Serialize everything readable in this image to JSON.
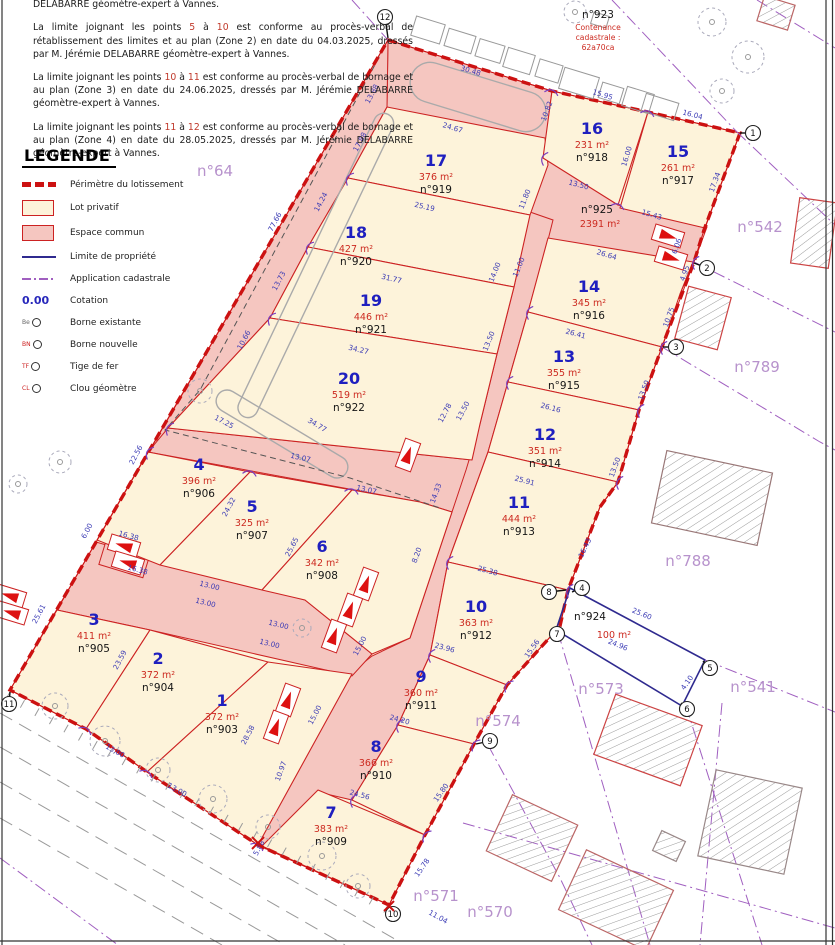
{
  "notes": {
    "paragraphs": [
      {
        "segments": [
          {
            "t": "bornage et au plan (Zone 1) en date du 14.10.2025, dressés par M. Jérémie DELABARRE géomètre-expert à Vannes."
          }
        ]
      },
      {
        "segments": [
          {
            "t": "La limite joignant les points "
          },
          {
            "t": "5",
            "hl": true
          },
          {
            "t": " à "
          },
          {
            "t": "10",
            "hl": true
          },
          {
            "t": " est conforme au procès-verbal de rétablissement des limites et au plan (Zone 2) en date du 04.03.2025, dressés par M. Jérémie DELABARRE géomètre-expert à Vannes."
          }
        ]
      },
      {
        "segments": [
          {
            "t": "La limite joignant les points "
          },
          {
            "t": "10",
            "hl": true
          },
          {
            "t": " à "
          },
          {
            "t": "11",
            "hl": true
          },
          {
            "t": " est conforme au procès-verbal de bornage et au plan (Zone 3) en date du 24.06.2025, dressés par M. Jérémie DELABARRE géomètre-expert à Vannes."
          }
        ]
      },
      {
        "segments": [
          {
            "t": "La limite joignant les points "
          },
          {
            "t": "11",
            "hl": true
          },
          {
            "t": " à "
          },
          {
            "t": "12",
            "hl": true
          },
          {
            "t": " est conforme au procès-verbal de bornage et au plan (Zone 4) en date du 28.05.2025, dressés par M. Jérémie DELABARRE géomètre-expert à Vannes."
          }
        ]
      }
    ]
  },
  "legend": {
    "title": "LEGENDE",
    "items": [
      {
        "kind": "perimetre",
        "label": "Périmètre du lotissement"
      },
      {
        "kind": "lot",
        "label": "Lot privatif"
      },
      {
        "kind": "commun",
        "label": "Espace commun"
      },
      {
        "kind": "limite",
        "label": "Limite de propriété"
      },
      {
        "kind": "cadastrale",
        "label": "Application cadastrale"
      },
      {
        "kind": "cotation",
        "label": "Cotation",
        "symbol": "0.00"
      },
      {
        "kind": "borne",
        "label": "Borne existante",
        "prefix": "Be",
        "color": "#666666"
      },
      {
        "kind": "borne",
        "label": "Borne nouvelle",
        "prefix": "BN",
        "color": "#cc2222"
      },
      {
        "kind": "borne",
        "label": "Tige de fer",
        "prefix": "TF",
        "color": "#cc2222"
      },
      {
        "kind": "borne",
        "label": "Clou géomètre",
        "prefix": "CL",
        "color": "#cc2222"
      }
    ]
  },
  "lots": [
    {
      "n": "1",
      "area": "372 m²",
      "parcel": "n°903",
      "x": 222,
      "y": 706
    },
    {
      "n": "2",
      "area": "372 m²",
      "parcel": "n°904",
      "x": 158,
      "y": 664
    },
    {
      "n": "3",
      "area": "411 m²",
      "parcel": "n°905",
      "x": 94,
      "y": 625
    },
    {
      "n": "4",
      "area": "396 m²",
      "parcel": "n°906",
      "x": 199,
      "y": 470
    },
    {
      "n": "5",
      "area": "325 m²",
      "parcel": "n°907",
      "x": 252,
      "y": 512
    },
    {
      "n": "6",
      "area": "342 m²",
      "parcel": "n°908",
      "x": 322,
      "y": 552
    },
    {
      "n": "7",
      "area": "383 m²",
      "parcel": "n°909",
      "x": 331,
      "y": 818
    },
    {
      "n": "8",
      "area": "366 m²",
      "parcel": "n°910",
      "x": 376,
      "y": 752
    },
    {
      "n": "9",
      "area": "360 m²",
      "parcel": "n°911",
      "x": 421,
      "y": 682
    },
    {
      "n": "10",
      "area": "363 m²",
      "parcel": "n°912",
      "x": 476,
      "y": 612
    },
    {
      "n": "11",
      "area": "444 m²",
      "parcel": "n°913",
      "x": 519,
      "y": 508
    },
    {
      "n": "12",
      "area": "351 m²",
      "parcel": "n°914",
      "x": 545,
      "y": 440
    },
    {
      "n": "13",
      "area": "355 m²",
      "parcel": "n°915",
      "x": 564,
      "y": 362
    },
    {
      "n": "14",
      "area": "345 m²",
      "parcel": "n°916",
      "x": 589,
      "y": 292
    },
    {
      "n": "15",
      "area": "261 m²",
      "parcel": "n°917",
      "x": 678,
      "y": 157
    },
    {
      "n": "16",
      "area": "231 m²",
      "parcel": "n°918",
      "x": 592,
      "y": 134
    },
    {
      "n": "17",
      "area": "376 m²",
      "parcel": "n°919",
      "x": 436,
      "y": 166
    },
    {
      "n": "18",
      "area": "427 m²",
      "parcel": "n°920",
      "x": 356,
      "y": 238
    },
    {
      "n": "19",
      "area": "446 m²",
      "parcel": "n°921",
      "x": 371,
      "y": 306
    },
    {
      "n": "20",
      "area": "519 m²",
      "parcel": "n°922",
      "x": 349,
      "y": 384
    }
  ],
  "common_areas": {
    "n923": {
      "name": "n°923",
      "lines": [
        "Contenance",
        "cadastrale :",
        "62a70ca"
      ],
      "x": 598,
      "y": 18
    },
    "n925": {
      "name": "n°925",
      "area": "2391 m²",
      "x": 597,
      "y": 213
    },
    "n924": {
      "name": "n°924",
      "area": "100 m²",
      "x": 590,
      "y": 620,
      "ax": 614,
      "ay": 638
    }
  },
  "neighbor_parcels": [
    {
      "label": "n°64",
      "x": 215,
      "y": 176
    },
    {
      "label": "n°542",
      "x": 760,
      "y": 232
    },
    {
      "label": "n°789",
      "x": 757,
      "y": 372
    },
    {
      "label": "n°788",
      "x": 688,
      "y": 566
    },
    {
      "label": "n°541",
      "x": 753,
      "y": 692
    },
    {
      "label": "n°573",
      "x": 601,
      "y": 694
    },
    {
      "label": "n°574",
      "x": 498,
      "y": 726
    },
    {
      "label": "n°571",
      "x": 436,
      "y": 901
    },
    {
      "label": "n°570",
      "x": 490,
      "y": 917
    }
  ],
  "boundary_points": [
    {
      "n": "1",
      "cx": 753,
      "cy": 133,
      "tx": 740,
      "ty": 133
    },
    {
      "n": "2",
      "cx": 707,
      "cy": 268,
      "tx": 694,
      "ty": 263
    },
    {
      "n": "3",
      "cx": 676,
      "cy": 347,
      "tx": 663,
      "ty": 347
    },
    {
      "n": "4",
      "cx": 582,
      "cy": 588,
      "tx": 572,
      "ty": 592
    },
    {
      "n": "5",
      "cx": 710,
      "cy": 668,
      "tx": 703,
      "ty": 661
    },
    {
      "n": "6",
      "cx": 687,
      "cy": 709,
      "tx": 681,
      "ty": 703
    },
    {
      "n": "7",
      "cx": 557,
      "cy": 634,
      "tx": 558,
      "ty": 628
    },
    {
      "n": "8",
      "cx": 549,
      "cy": 592,
      "tx": 566,
      "ty": 590
    },
    {
      "n": "9",
      "cx": 490,
      "cy": 741,
      "tx": 476,
      "ty": 744
    },
    {
      "n": "10",
      "cx": 393,
      "cy": 914,
      "tx": 389,
      "ty": 906
    },
    {
      "n": "11",
      "cx": 9,
      "cy": 704,
      "tx": 10,
      "ty": 692
    },
    {
      "n": "12",
      "cx": 385,
      "cy": 17,
      "tx": 388,
      "ty": 38
    }
  ],
  "dimensions": [
    [
      "30.48",
      470,
      73,
      17
    ],
    [
      "24.67",
      452,
      130,
      17
    ],
    [
      "15.95",
      602,
      97,
      17
    ],
    [
      "16.04",
      692,
      117,
      15
    ],
    [
      "17.34",
      717,
      183,
      -70
    ],
    [
      "10.82",
      549,
      112,
      -70
    ],
    [
      "16.00",
      629,
      157,
      -73
    ],
    [
      "13.50",
      578,
      187,
      15
    ],
    [
      "15.43",
      651,
      217,
      17
    ],
    [
      "26.64",
      606,
      257,
      17
    ],
    [
      "6.06",
      679,
      247,
      -70
    ],
    [
      "4.95",
      687,
      274,
      -70
    ],
    [
      "10.75",
      671,
      318,
      -70
    ],
    [
      "26.41",
      575,
      336,
      15
    ],
    [
      "13.50",
      646,
      391,
      -70
    ],
    [
      "26.16",
      550,
      410,
      15
    ],
    [
      "13.50",
      617,
      468,
      -70
    ],
    [
      "25.91",
      524,
      483,
      15
    ],
    [
      "16.43",
      587,
      549,
      -64
    ],
    [
      "25.38",
      487,
      573,
      15
    ],
    [
      "15.56",
      534,
      650,
      -55
    ],
    [
      "23.96",
      444,
      650,
      15
    ],
    [
      "24.20",
      399,
      722,
      15
    ],
    [
      "15.80",
      443,
      794,
      -55
    ],
    [
      "24.56",
      359,
      797,
      15
    ],
    [
      "15.78",
      424,
      869,
      -55
    ],
    [
      "25.19",
      424,
      209,
      13
    ],
    [
      "31.77",
      391,
      281,
      13
    ],
    [
      "34.27",
      358,
      352,
      13
    ],
    [
      "34.77",
      316,
      427,
      31
    ],
    [
      "17.25",
      223,
      424,
      28
    ],
    [
      "13.07",
      300,
      460,
      13
    ],
    [
      "13.07",
      366,
      492,
      13
    ],
    [
      "24.32",
      231,
      508,
      -62
    ],
    [
      "25.65",
      294,
      548,
      -62
    ],
    [
      "17.88",
      362,
      143,
      -62
    ],
    [
      "14.24",
      323,
      203,
      -62
    ],
    [
      "13.73",
      281,
      282,
      -62
    ],
    [
      "10.66",
      246,
      341,
      -62
    ],
    [
      "77.66",
      277,
      223,
      -62
    ],
    [
      "13.88",
      374,
      95,
      -62
    ],
    [
      "22.56",
      138,
      456,
      -62
    ],
    [
      "6.00",
      89,
      532,
      -62
    ],
    [
      "25.61",
      41,
      615,
      -62
    ],
    [
      "23.59",
      122,
      661,
      -62
    ],
    [
      "28.58",
      250,
      736,
      -62
    ],
    [
      "13.00",
      209,
      588,
      14
    ],
    [
      "13.00",
      205,
      605,
      14
    ],
    [
      "13.00",
      278,
      627,
      14
    ],
    [
      "13.00",
      269,
      646,
      14
    ],
    [
      "13.00",
      114,
      753,
      29
    ],
    [
      "13.00",
      176,
      792,
      29
    ],
    [
      "14.33",
      438,
      494,
      -70
    ],
    [
      "8.20",
      419,
      556,
      -70
    ],
    [
      "12.78",
      447,
      414,
      -62
    ],
    [
      "13.50",
      465,
      412,
      -62
    ],
    [
      "15.00",
      362,
      647,
      -62
    ],
    [
      "15.00",
      317,
      716,
      -62
    ],
    [
      "25.60",
      641,
      616,
      22
    ],
    [
      "24.96",
      617,
      647,
      22
    ],
    [
      "4.10",
      689,
      684,
      -55
    ],
    [
      "11.00",
      521,
      268,
      -68
    ],
    [
      "14.00",
      497,
      273,
      -68
    ],
    [
      "13.50",
      491,
      342,
      -68
    ],
    [
      "16.38",
      128,
      538,
      15
    ],
    [
      "16.38",
      137,
      572,
      15
    ],
    [
      "5.88",
      261,
      849,
      -62
    ],
    [
      "11.04",
      437,
      919,
      29
    ],
    [
      "11.80",
      527,
      200,
      -68
    ],
    [
      "10.97",
      283,
      772,
      -70
    ]
  ],
  "colors": {
    "perimeter": "#cc1111",
    "lot_fill": "#fdf3da",
    "common_fill": "#f5c6c0",
    "lot_stro": "#cc2222",
    "dimension_text": "#3b3bb5",
    "lot_number": "#1f1fbf",
    "area_text": "#cc2a20",
    "neighbor_text": "#b792cc",
    "cadastral_line": "#a05fc0",
    "property_line": "#2f2a8f"
  }
}
